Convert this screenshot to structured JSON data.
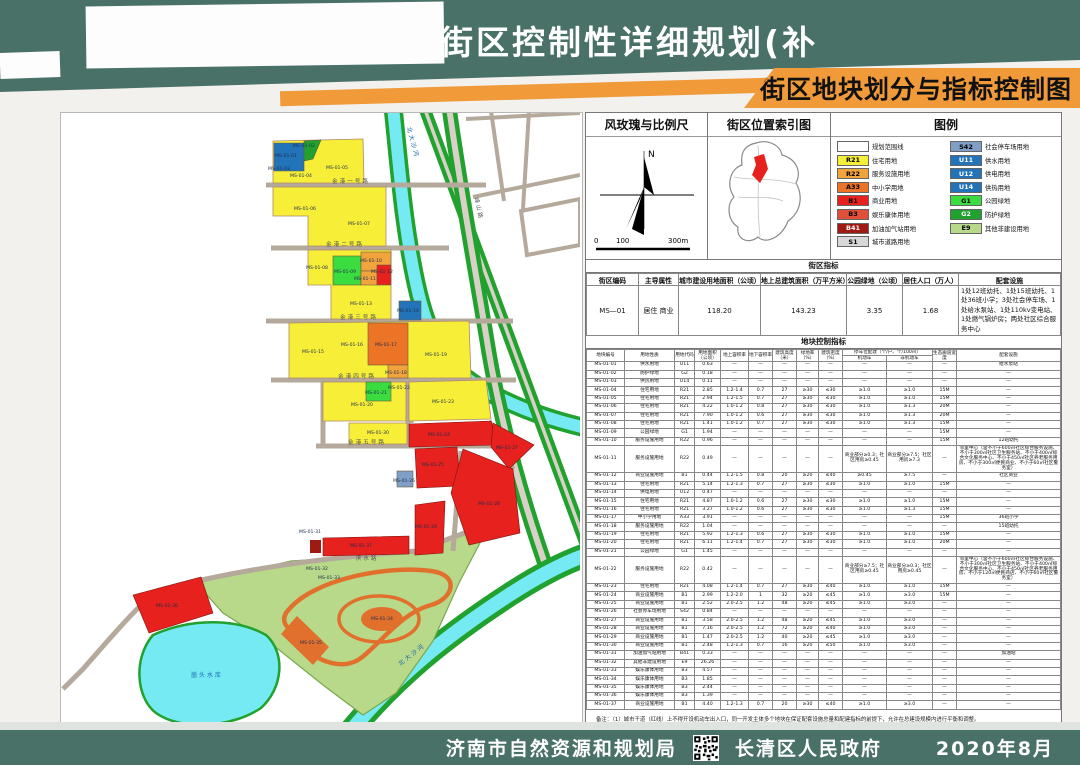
{
  "header": {
    "title": "山镇金港街区控制性详细规划(补",
    "plate": "街区地块划分与指标控制图"
  },
  "footer": {
    "org1": "济南市自然资源和规划局",
    "org2": "长清区人民政府",
    "date": "2020年8月",
    "qr_icon": "qr-code"
  },
  "colors": {
    "teal": "#4a7168",
    "orange": "#f09a3a",
    "R21": "#f6ee37",
    "R22": "#f2a43c",
    "A33": "#ec7426",
    "B1": "#e7211d",
    "B3": "#e05038",
    "B41": "#9e1a12",
    "S1": "#d8d8d8",
    "S42": "#7f9fc6",
    "U": "#2273b8",
    "G1": "#3bdc3f",
    "G2": "#21a12d",
    "E9": "#b7d989",
    "water": "#76eaf2"
  },
  "panel": {
    "windrose_title": "风玫瑰与比例尺",
    "north_label": "N",
    "scale_labels": [
      "0",
      "100",
      "300m"
    ],
    "index_title": "街区位置索引图",
    "legend_title": "图例",
    "legend_left": [
      {
        "code": "",
        "label": "规划范围线",
        "color": "#ffffff",
        "tc": "#000"
      },
      {
        "code": "R21",
        "label": "住宅用地",
        "color": "#f6ee37",
        "tc": "#000"
      },
      {
        "code": "R22",
        "label": "服务设施用地",
        "color": "#f2a43c",
        "tc": "#000"
      },
      {
        "code": "A33",
        "label": "中小学用地",
        "color": "#ec7426",
        "tc": "#000"
      },
      {
        "code": "B1",
        "label": "商业用地",
        "color": "#e7211d",
        "tc": "#000"
      },
      {
        "code": "B3",
        "label": "娱乐康体用地",
        "color": "#e05038",
        "tc": "#000"
      },
      {
        "code": "B41",
        "label": "加油加气站用地",
        "color": "#9e1a12",
        "tc": "#fff"
      },
      {
        "code": "S1",
        "label": "城市道路用地",
        "color": "#d8d8d8",
        "tc": "#000"
      }
    ],
    "legend_right": [
      {
        "code": "S42",
        "label": "社会停车场用地",
        "color": "#7f9fc6",
        "tc": "#000"
      },
      {
        "code": "U11",
        "label": "供水用地",
        "color": "#2273b8",
        "tc": "#fff"
      },
      {
        "code": "U12",
        "label": "供电用地",
        "color": "#2273b8",
        "tc": "#fff"
      },
      {
        "code": "U14",
        "label": "供热用地",
        "color": "#2273b8",
        "tc": "#fff"
      },
      {
        "code": "G1",
        "label": "公园绿地",
        "color": "#3bdc3f",
        "tc": "#000"
      },
      {
        "code": "G2",
        "label": "防护绿地",
        "color": "#21a12d",
        "tc": "#fff"
      },
      {
        "code": "E9",
        "label": "其他非建设用地",
        "color": "#b7d989",
        "tc": "#000"
      }
    ],
    "district_band": "街区指标",
    "district_headers": [
      "街区编码",
      "主导属性",
      "城市建设用地面积（公顷）",
      "地上总建筑面积（万平方米）",
      "公园绿地（公顷）",
      "居住人口（万人）",
      "配套设施"
    ],
    "district_row": [
      "MS—01",
      "居住 商业",
      "118.20",
      "143.23",
      "3.35",
      "1.68",
      "1处12班幼托、1处15班幼托、1处36班小学；3处社会停车场、1处给水泵站、1处110kv变电站、1处燃气锅炉房；两处社区综合服务中心"
    ],
    "plot_band": "地块控制指标",
    "plot_head_left": [
      "地块编号",
      "用地性质",
      "用地代码",
      "用地面积（公顷）",
      "地上容积率",
      "地下容积率",
      "建筑高度（米）",
      "绿地率（%）",
      "建筑密度（%）"
    ],
    "parking_group": "停车位配建（个/户、个/100㎡）",
    "parking_sub": [
      "机动车",
      "非机动车"
    ],
    "plot_head_right": [
      "生态廊道宽度",
      "配套设施"
    ],
    "plot_rows": [
      [
        "MS-01-01",
        "供水用地",
        "U11",
        "0.63",
        "—",
        "—",
        "—",
        "—",
        "—",
        "—",
        "—",
        "—",
        "给水泵站"
      ],
      [
        "MS-01-02",
        "防护绿地",
        "G2",
        "0.18",
        "—",
        "—",
        "—",
        "—",
        "—",
        "—",
        "—",
        "—",
        "—"
      ],
      [
        "MS-01-03",
        "供热用地",
        "U14",
        "0.11",
        "—",
        "—",
        "—",
        "—",
        "—",
        "—",
        "—",
        "—",
        "—"
      ],
      [
        "MS-01-04",
        "住宅用地",
        "R21",
        "2.85",
        "1.2-1.4",
        "0.7",
        "27",
        "≥30",
        "≤30",
        "≥1.0",
        "≥1.0",
        "15M",
        "—"
      ],
      [
        "MS-01-05",
        "住宅用地",
        "R21",
        "2.94",
        "1.2-1.5",
        "0.7",
        "27",
        "≥30",
        "≤30",
        "≥1.0",
        "≥1.0",
        "15M",
        "—"
      ],
      [
        "MS-01-06",
        "住宅用地",
        "R21",
        "4.22",
        "1.0-1.2",
        "0.8",
        "27",
        "≥30",
        "≤30",
        "≥1.0",
        "≥1.3",
        "20M",
        "—"
      ],
      [
        "MS-01-07",
        "住宅用地",
        "R21",
        "7.90",
        "1.0-1.2",
        "0.6",
        "27",
        "≥30",
        "≤30",
        "≥1.0",
        "≥1.3",
        "20M",
        "—"
      ],
      [
        "MS-01-08",
        "住宅用地",
        "R21",
        "1.41",
        "1.0-1.2",
        "0.7",
        "27",
        "≥30",
        "≤30",
        "≥1.0",
        "≥1.3",
        "15M",
        "—"
      ],
      [
        "MS-01-09",
        "公园绿地",
        "G1",
        "1.94",
        "—",
        "—",
        "—",
        "—",
        "—",
        "—",
        "—",
        "15M",
        "—"
      ],
      [
        "MS-01-10",
        "服务设施用地",
        "R22",
        "0.96",
        "—",
        "—",
        "—",
        "—",
        "—",
        "—",
        "—",
        "15M",
        "12班幼托"
      ],
      [
        "MS-01-11",
        "服务设施用地",
        "R22",
        "0.49",
        "—",
        "—",
        "—",
        "—",
        "—",
        "商业部分≥0.3；社区用房≥0.45",
        "商业部分≥7.5；社区用房≥7.3",
        "—",
        "邻里中心（含不小于600㎡社区综合服务设施、不小于300㎡社区卫生服务站、不小于400㎡综合文化服务中心、不小于450㎡社区养老服务用房、不小于300㎡便民商业、不小于60㎡社区警务室）"
      ],
      [
        "MS-01-12",
        "商业设施用地",
        "B1",
        "0.44",
        "1.2-1.5",
        "0.8",
        "20",
        "≥20",
        "≤40",
        "≥0.45",
        "≥7.5",
        "—",
        "社区商业"
      ],
      [
        "MS-01-13",
        "住宅用地",
        "R21",
        "5.14",
        "1.2-1.3",
        "0.7",
        "27",
        "≥30",
        "≤30",
        "≥1.0",
        "≥1.0",
        "15M",
        "—"
      ],
      [
        "MS-01-14",
        "供电用地",
        "U12",
        "0.47",
        "—",
        "—",
        "—",
        "—",
        "—",
        "—",
        "—",
        "—",
        "—"
      ],
      [
        "MS-01-15",
        "住宅用地",
        "R21",
        "4.87",
        "1.0-1.2",
        "0.6",
        "27",
        "≥30",
        "≤30",
        "≥1.0",
        "≥1.0",
        "15M",
        "—"
      ],
      [
        "MS-01-16",
        "住宅用地",
        "R21",
        "3.27",
        "1.0-1.2",
        "0.6",
        "27",
        "≥30",
        "≤30",
        "≥1.0",
        "≥1.3",
        "15M",
        "—"
      ],
      [
        "MS-01-17",
        "中小学用地",
        "A33",
        "3.91",
        "—",
        "—",
        "—",
        "—",
        "—",
        "—",
        "—",
        "15M",
        "36班小学"
      ],
      [
        "MS-01-18",
        "服务设施用地",
        "R22",
        "1.04",
        "—",
        "—",
        "—",
        "—",
        "—",
        "—",
        "—",
        "—",
        "15班幼托"
      ],
      [
        "MS-01-19",
        "住宅用地",
        "R21",
        "5.92",
        "1.2-1.3",
        "0.6",
        "27",
        "≥30",
        "≤30",
        "≥1.0",
        "≥1.0",
        "15M",
        "—"
      ],
      [
        "MS-01-20",
        "住宅用地",
        "R21",
        "6.11",
        "1.2-1.4",
        "0.7",
        "27",
        "≥30",
        "≤30",
        "≥1.0",
        "≥1.0",
        "20M",
        "—"
      ],
      [
        "MS-01-21",
        "公园绿地",
        "G1",
        "1.45",
        "—",
        "—",
        "—",
        "—",
        "—",
        "—",
        "—",
        "—",
        "—"
      ],
      [
        "MS-01-22",
        "服务设施用地",
        "R22",
        "0.42",
        "—",
        "—",
        "—",
        "—",
        "—",
        "商业部分≥7.5；社区用房≥0.45",
        "商业部分≥0.3；社区用房≥0.45",
        "—",
        "邻里中心（含不小于600㎡社区综合服务设施、不小于300㎡社区卫生服务站、不小于400㎡综合文化服务中心、不小于450㎡社区养老服务用房、不小于120㎡便民商店、不小于60㎡社区警务室）"
      ],
      [
        "MS-01-23",
        "住宅用地",
        "R21",
        "4.08",
        "1.2-1.4",
        "0.7",
        "27",
        "≥30",
        "≤40",
        "≥1.0",
        "≥1.0",
        "15M",
        "—"
      ],
      [
        "MS-01-24",
        "商业设施用地",
        "B1",
        "2.99",
        "1.2-2.0",
        "1",
        "32",
        "≥20",
        "≤45",
        "≥1.0",
        "≥3.0",
        "15M",
        "—"
      ],
      [
        "MS-01-25",
        "商业设施用地",
        "B1",
        "2.52",
        "2.0-2.5",
        "1.2",
        "48",
        "≥20",
        "≤45",
        "≥1.0",
        "≥3.0",
        "—",
        "—"
      ],
      [
        "MS-01-26",
        "社会停车场用地",
        "S42",
        "0.84",
        "—",
        "—",
        "—",
        "—",
        "—",
        "—",
        "—",
        "—",
        "—"
      ],
      [
        "MS-01-27",
        "商业设施用地",
        "B1",
        "3.58",
        "2.0-2.5",
        "1.2",
        "48",
        "≥20",
        "≤45",
        "≥1.0",
        "≥3.0",
        "—",
        "—"
      ],
      [
        "MS-01-28",
        "商业设施用地",
        "B1",
        "7.16",
        "2.0-2.5",
        "1.2",
        "72",
        "≥20",
        "≤40",
        "≥1.0",
        "≥3.0",
        "—",
        "—"
      ],
      [
        "MS-01-29",
        "商业设施用地",
        "B1",
        "1.47",
        "2.0-2.5",
        "1.2",
        "40",
        "≥20",
        "≤45",
        "≥1.0",
        "≥3.0",
        "—",
        "—"
      ],
      [
        "MS-01-30",
        "商业设施用地",
        "B1",
        "2.48",
        "1.2-1.3",
        "0.7",
        "16",
        "≥20",
        "≤50",
        "≥1.0",
        "≥3.0",
        "—",
        "—"
      ],
      [
        "MS-01-31",
        "加油加气站用地",
        "B41",
        "0.33",
        "—",
        "—",
        "—",
        "—",
        "—",
        "—",
        "—",
        "—",
        "加油站"
      ],
      [
        "MS-01-32",
        "其他非建设用地",
        "E9",
        "26.26",
        "—",
        "—",
        "—",
        "—",
        "—",
        "—",
        "—",
        "—",
        "—"
      ],
      [
        "MS-01-33",
        "娱乐康体用地",
        "B3",
        "4.57",
        "—",
        "—",
        "—",
        "—",
        "—",
        "—",
        "—",
        "—",
        "—"
      ],
      [
        "MS-01-34",
        "娱乐康体用地",
        "B3",
        "1.85",
        "—",
        "—",
        "—",
        "—",
        "—",
        "—",
        "—",
        "—",
        "—"
      ],
      [
        "MS-01-35",
        "娱乐康体用地",
        "B3",
        "2.44",
        "—",
        "—",
        "—",
        "—",
        "—",
        "—",
        "—",
        "—",
        "—"
      ],
      [
        "MS-01-36",
        "娱乐康体用地",
        "B3",
        "1.39",
        "—",
        "—",
        "—",
        "—",
        "—",
        "—",
        "—",
        "—",
        "—"
      ],
      [
        "MS-01-37",
        "商业设施用地",
        "B1",
        "4.40",
        "1.2-1.3",
        "0.7",
        "20",
        "≥30",
        "≤40",
        "≥1.0",
        "≥3.0",
        "—",
        "—"
      ]
    ],
    "notes": [
      "备注：（1）城市干道（红线）上不得开设机动车出入口，同一开发主体多个地块在保证配套设施总量和配建指标的前提下，允许在总建设规模内进行平衡和调整。",
      "（2）居住地块内配套设施规模不变的前提下，允许在地块内适当调整位置。",
      "（3）带注地块，配套建设指标均为下限控制。"
    ]
  },
  "map": {
    "parcel_labels": [
      {
        "t": "MS-01-01",
        "x": 225,
        "y": 44,
        "c": "#ffffff"
      },
      {
        "t": "MS-01-02",
        "x": 243,
        "y": 34
      },
      {
        "t": "MS-01-03",
        "x": 218,
        "y": 57
      },
      {
        "t": "MS-01-04",
        "x": 240,
        "y": 64
      },
      {
        "t": "MS-01-05",
        "x": 276,
        "y": 56
      },
      {
        "t": "MS-01-06",
        "x": 244,
        "y": 97
      },
      {
        "t": "MS-01-07",
        "x": 298,
        "y": 112
      },
      {
        "t": "MS-01-08",
        "x": 256,
        "y": 156
      },
      {
        "t": "MS-01-09",
        "x": 284,
        "y": 160
      },
      {
        "t": "MS-01-10",
        "x": 310,
        "y": 149
      },
      {
        "t": "MS-01-11",
        "x": 304,
        "y": 167
      },
      {
        "t": "MS-01-12",
        "x": 321,
        "y": 160,
        "c": "#ffffff"
      },
      {
        "t": "MS-01-13",
        "x": 300,
        "y": 192
      },
      {
        "t": "MS-01-14",
        "x": 347,
        "y": 199,
        "c": "#ffffff"
      },
      {
        "t": "MS-01-15",
        "x": 252,
        "y": 240
      },
      {
        "t": "MS-01-16",
        "x": 291,
        "y": 233
      },
      {
        "t": "MS-01-17",
        "x": 325,
        "y": 233
      },
      {
        "t": "MS-01-18",
        "x": 335,
        "y": 261
      },
      {
        "t": "MS-01-19",
        "x": 375,
        "y": 243
      },
      {
        "t": "MS-01-20",
        "x": 301,
        "y": 293
      },
      {
        "t": "MS-01-21",
        "x": 315,
        "y": 281
      },
      {
        "t": "MS-01-22",
        "x": 338,
        "y": 276
      },
      {
        "t": "MS-01-23",
        "x": 382,
        "y": 290
      },
      {
        "t": "MS-01-24",
        "x": 378,
        "y": 323
      },
      {
        "t": "MS-01-25",
        "x": 372,
        "y": 353
      },
      {
        "t": "MS-01-26",
        "x": 343,
        "y": 369
      },
      {
        "t": "MS-01-27",
        "x": 446,
        "y": 336
      },
      {
        "t": "MS-01-28",
        "x": 428,
        "y": 392,
        "c": "#ffffff"
      },
      {
        "t": "MS-01-29",
        "x": 365,
        "y": 415
      },
      {
        "t": "MS-01-30",
        "x": 317,
        "y": 321
      },
      {
        "t": "MS-01-31",
        "x": 249,
        "y": 420
      },
      {
        "t": "MS-01-32",
        "x": 256,
        "y": 457
      },
      {
        "t": "MS-01-33",
        "x": 268,
        "y": 466
      },
      {
        "t": "MS-01-34",
        "x": 321,
        "y": 507,
        "c": "#ffffff"
      },
      {
        "t": "MS-01-35",
        "x": 250,
        "y": 531
      },
      {
        "t": "MS-01-36",
        "x": 106,
        "y": 494
      },
      {
        "t": "MS-01-37",
        "x": 300,
        "y": 434
      }
    ],
    "road_labels": [
      {
        "t": "金港一号路",
        "x": 290,
        "y": 70
      },
      {
        "t": "金港二号路",
        "x": 284,
        "y": 133
      },
      {
        "t": "金港三号路",
        "x": 298,
        "y": 206
      },
      {
        "t": "金港四号路",
        "x": 296,
        "y": 265
      },
      {
        "t": "金港五号路",
        "x": 306,
        "y": 331
      },
      {
        "t": "滨水路",
        "x": 306,
        "y": 447
      },
      {
        "t": "峰山路",
        "x": 416,
        "y": 96,
        "r": 78
      }
    ],
    "water_labels": [
      {
        "t": "北大沙河",
        "x": 350,
        "y": 30,
        "r": 75
      },
      {
        "t": "北大沙河",
        "x": 352,
        "y": 543,
        "r": -38
      },
      {
        "t": "崮头水库",
        "x": 146,
        "y": 564
      }
    ]
  }
}
